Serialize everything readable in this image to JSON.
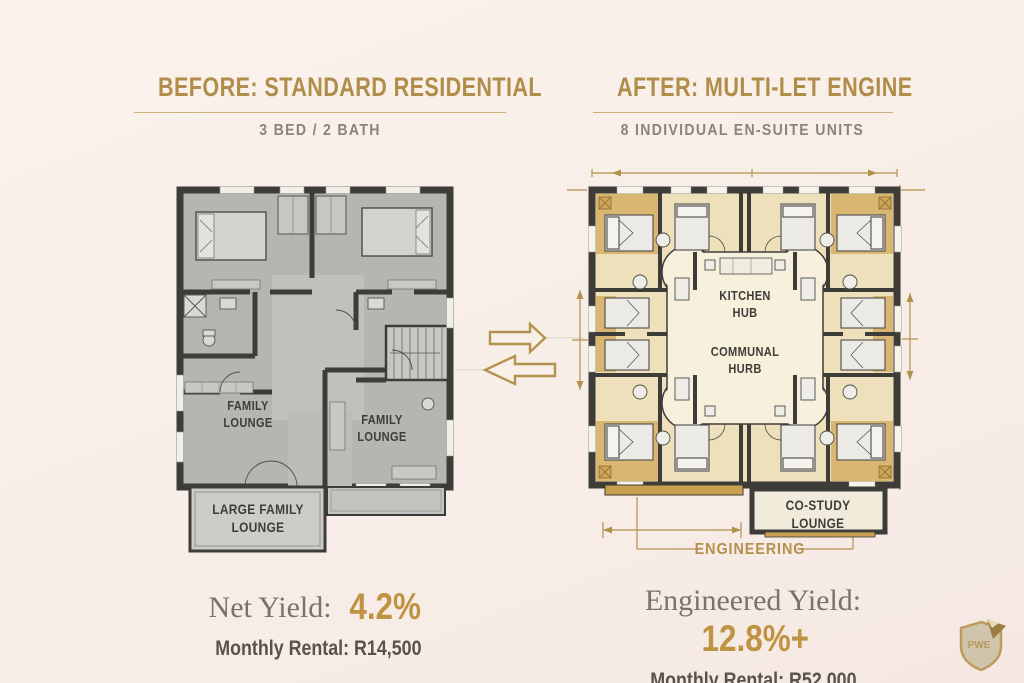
{
  "theme": {
    "background": "#f8eee8",
    "gold": "#b3914c",
    "wall": "#3d3c38",
    "before_floor": "#b5b6b2",
    "after_floor": "#eee0ba",
    "yield_value_color": "#bf9341"
  },
  "before": {
    "title": "BEFORE: STANDARD RESIDENTIAL",
    "subtitle": "3 BED / 2 BATH",
    "rooms": {
      "lounge_left": "FAMILY LOUNGE",
      "lounge_right": "FAMILY LOUNGE",
      "porch": "LARGE FAMILY LOUNGE"
    },
    "yield_label": "Net Yield:",
    "yield_value": "4.2%",
    "rental_label": "Monthly Rental: R14,500"
  },
  "after": {
    "title": "AFTER: MULTI-LET ENGINE",
    "subtitle": "8 INDIVIDUAL EN-SUITE UNITS",
    "rooms": {
      "kitchen": "KITCHEN HUB",
      "communal": "COMMUNAL HURB",
      "costudy": "CO-STUDY LOUNGE"
    },
    "annotation": "ENGINEERING",
    "yield_label": "Engineered Yield:",
    "yield_value": "12.8%+",
    "rental_label": "Monthly Rental: R52.000"
  },
  "logo": {
    "monogram": "PWE"
  }
}
